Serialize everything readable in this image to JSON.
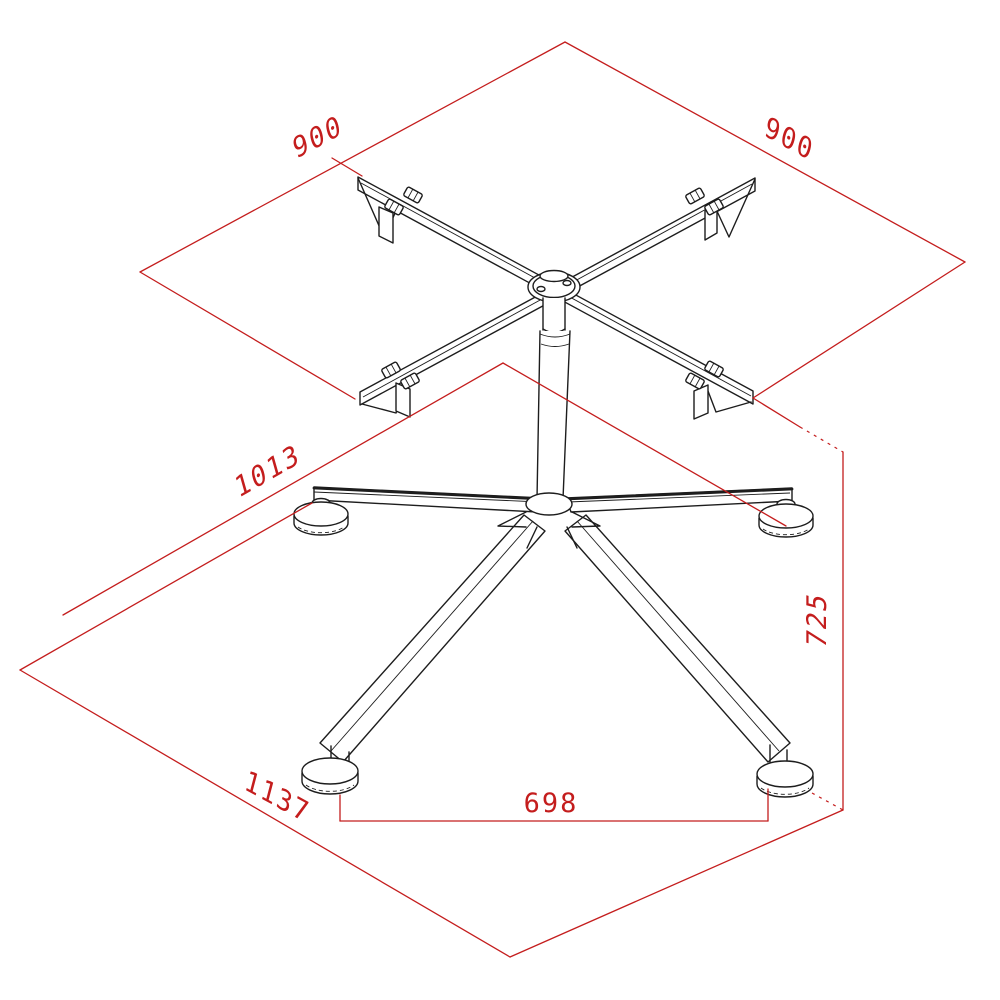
{
  "colors": {
    "dimension": "#c41d1d",
    "line": "#1d1d1d",
    "background": "#ffffff"
  },
  "dimensions": {
    "top_edge_left": {
      "value": "900"
    },
    "top_edge_right": {
      "value": "900"
    },
    "base_diagonal": {
      "value": "1013"
    },
    "height": {
      "value": "725"
    },
    "base_edge": {
      "value": "1137"
    },
    "front_feet_spacing": {
      "value": "698"
    }
  }
}
